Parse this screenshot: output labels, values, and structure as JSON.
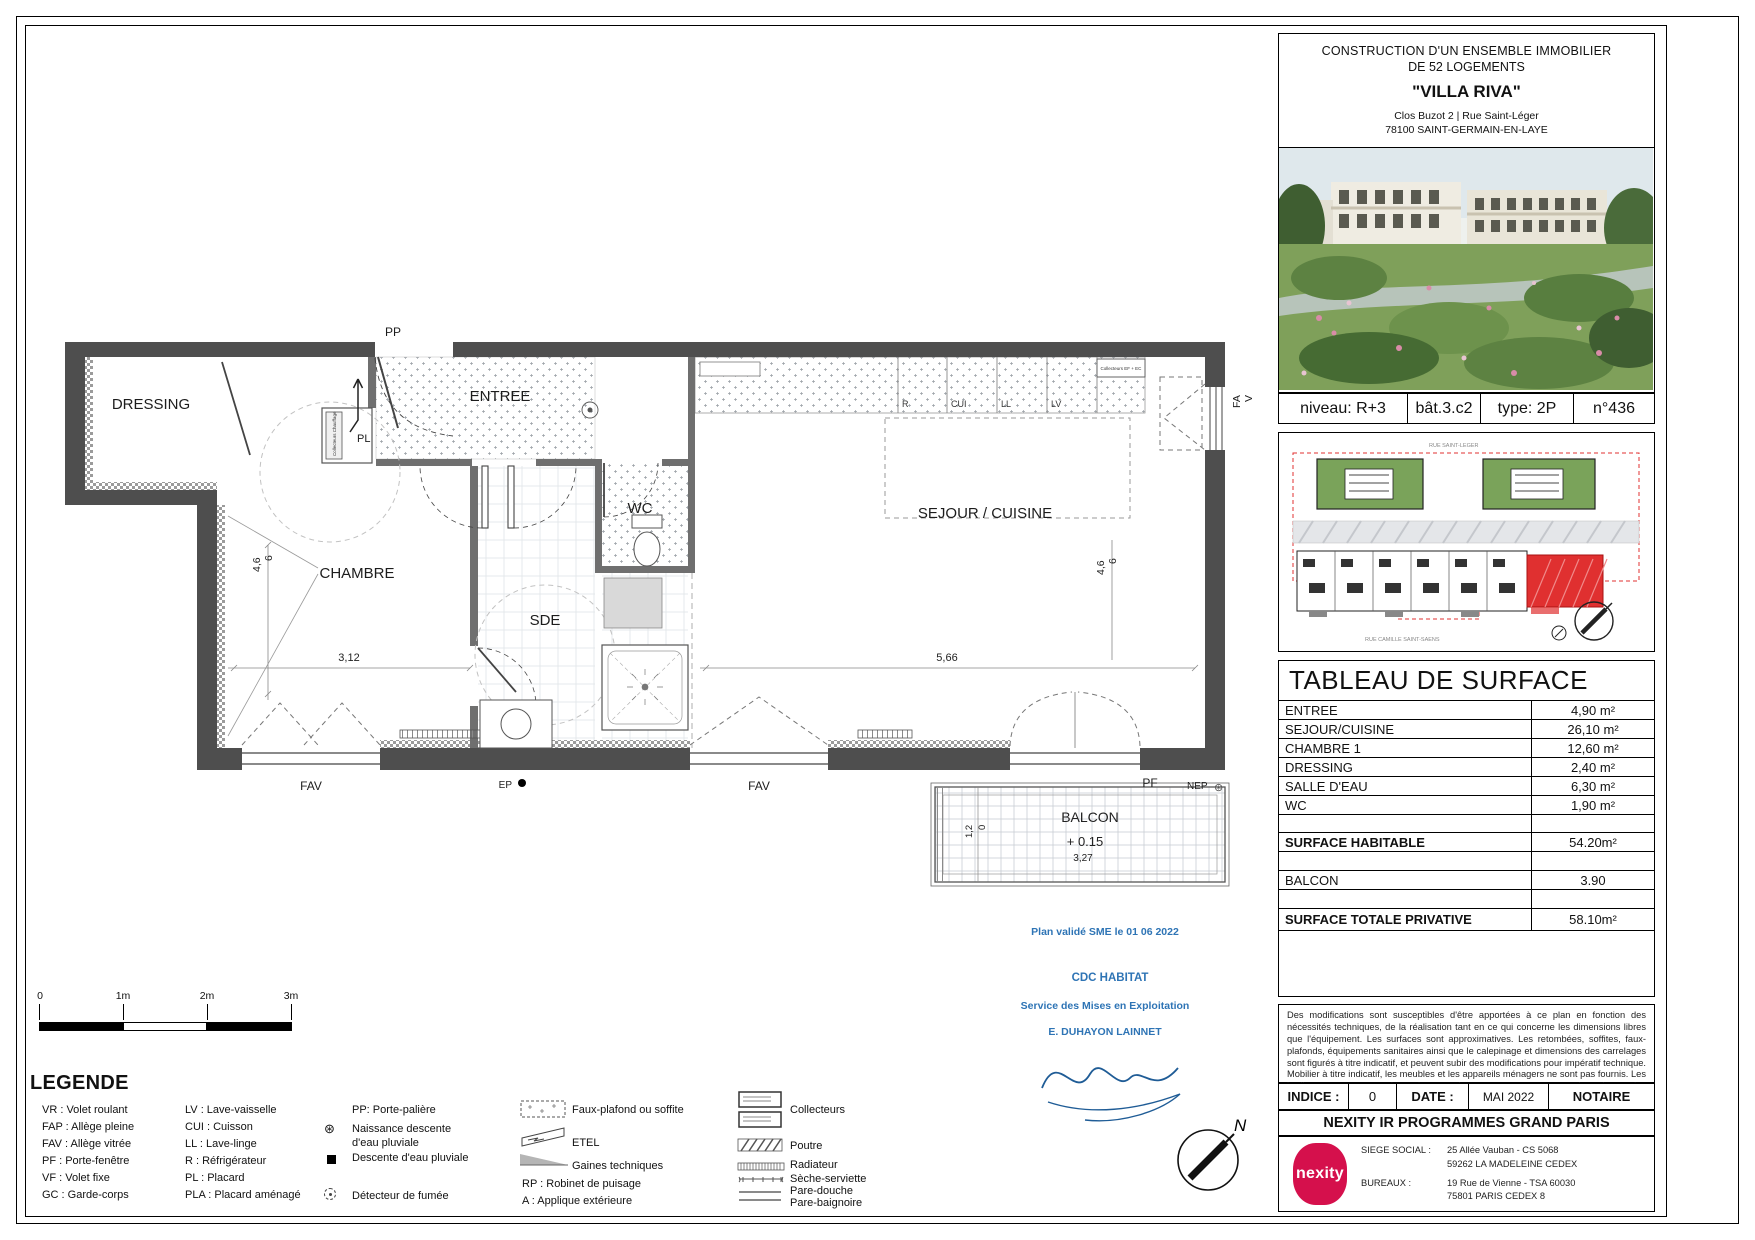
{
  "title_block": {
    "line1": "CONSTRUCTION D'UN ENSEMBLE IMMOBILIER",
    "line2": "DE 52 LOGEMENTS",
    "name": "\"VILLA RIVA\"",
    "address1": "Clos Buzot 2 | Rue Saint-Léger",
    "address2": "78100 SAINT-GERMAIN-EN-LAYE"
  },
  "info_row": {
    "niveau": "niveau: R+3",
    "bat": "bât.3.c2",
    "type": "type: 2P",
    "num": "n°436"
  },
  "site_plan": {
    "street_top": "RUE SAINT-LEGER",
    "street_bottom": "RUE CAMILLE SAINT-SAENS"
  },
  "surface_table": {
    "title": "TABLEAU DE SURFACE",
    "rows": [
      {
        "label": "ENTREE",
        "value": "4,90 m²"
      },
      {
        "label": "SEJOUR/CUISINE",
        "value": "26,10 m²"
      },
      {
        "label": "CHAMBRE 1",
        "value": "12,60 m²"
      },
      {
        "label": "DRESSING",
        "value": "2,40 m²"
      },
      {
        "label": "SALLE D'EAU",
        "value": "6,30 m²"
      },
      {
        "label": "WC",
        "value": "1,90 m²"
      }
    ],
    "habitable": {
      "label": "SURFACE HABITABLE",
      "value": "54.20m²"
    },
    "balcon": {
      "label": "BALCON",
      "value": "3.90"
    },
    "total": {
      "label": "SURFACE TOTALE PRIVATIVE",
      "value": "58.10m²"
    }
  },
  "notes": "Des modifications sont susceptibles d'être apportées à ce plan en fonction des nécessités techniques, de la réalisation tant en ce qui concerne les dimensions libres que l'équipement. Les surfaces sont approximatives. Les retombées, soffites, faux-plafonds, équipements sanitaires ainsi que le calepinage et dimensions des carrelages sont figurés à titre indicatif, et peuvent subir des modifications pour impératif technique. Mobilier à titre indicatif, les meubles et les appareils ménagers ne sont pas fournis. Les jardins ne seront pas nécessairement plats et pourront comporter des talus et des pentes.",
  "revision": {
    "indice_label": "INDICE :",
    "indice": "0",
    "date_label": "DATE :",
    "date": "MAI 2022",
    "notaire": "NOTAIRE"
  },
  "company": {
    "name": "NEXITY IR PROGRAMMES GRAND PARIS",
    "logo": "nexity",
    "siege_label": "SIEGE SOCIAL :",
    "siege1": "25 Allée Vauban - CS 5068",
    "siege2": "59262 LA MADELEINE CEDEX",
    "bureaux_label": "BUREAUX :",
    "bureaux1": "19 Rue de Vienne - TSA 60030",
    "bureaux2": "75801 PARIS CEDEX 8"
  },
  "scale_bar": {
    "t0": "0",
    "t1": "1m",
    "t2": "2m",
    "t3": "3m"
  },
  "legend": {
    "title": "LEGENDE",
    "abbr1": [
      "VR : Volet roulant",
      "FAP : Allège pleine",
      "FAV : Allège vitrée",
      "PF : Porte-fenêtre",
      "VF : Volet fixe",
      "GC : Garde-corps"
    ],
    "abbr2": [
      "LV : Lave-vaisselle",
      "CUI : Cuisson",
      "LL : Lave-linge",
      "R : Réfrigérateur",
      "PL : Placard",
      "PLA : Placard aménagé"
    ],
    "pp": "PP: Porte-palière",
    "naissance": "Naissance descente d'eau pluviale",
    "descente": "Descente d'eau pluviale",
    "detecteur": "Détecteur de fumée",
    "faux_plafond": "Faux-plafond ou soffite",
    "etel": "ETEL",
    "gaines": "Gaines techniques",
    "rp": "RP : Robinet de puisage",
    "applique": "A : Applique extérieure",
    "collecteurs": "Collecteurs",
    "poutre": "Poutre",
    "radiateur": "Radiateur",
    "seche": "Sèche-serviette",
    "pare_douche": "Pare-douche",
    "pare_baignoire": "Pare-baignoire"
  },
  "plan": {
    "pp": "PP",
    "dressing": "DRESSING",
    "entree": "ENTREE",
    "pl": "PL",
    "wc": "WC",
    "chambre": "CHAMBRE",
    "sde": "SDE",
    "sejour": "SEJOUR / CUISINE",
    "kitchen": [
      "R",
      "CUI",
      "LL",
      "LV"
    ],
    "collecteurs_efec": "Collecteurs EF + EC",
    "collecteurs_chauffage": "Collecteurs Chauffage",
    "dims": {
      "left_a": "4,6",
      "left_b": "6",
      "chambre": "3,12",
      "sejour": "5,66",
      "right_a": "4,6",
      "right_b": "6",
      "balcon_w": "3,27",
      "balcon_d1": "1,2",
      "balcon_d2": "0"
    },
    "labels": {
      "fav1": "FAV",
      "ep": "EP",
      "fav2": "FAV",
      "pf": "PF",
      "nep": "NEP",
      "fa": "FA",
      "v": "V"
    },
    "balcon": {
      "name": "BALCON",
      "level": "+ 0.15"
    }
  },
  "validation": {
    "line1": "Plan validé SME le 01 06 2022",
    "line2": "CDC HABITAT",
    "line3": "Service des Mises en Exploitation",
    "line4": "E. DUHAYON LAINNET"
  },
  "compass": {
    "north": "N"
  },
  "colors": {
    "wall": "#4e4e4e",
    "blue": "#2E74B5",
    "nexity_red": "#D5104C",
    "site_red": "#E03030",
    "site_green": "#6B9A50"
  }
}
